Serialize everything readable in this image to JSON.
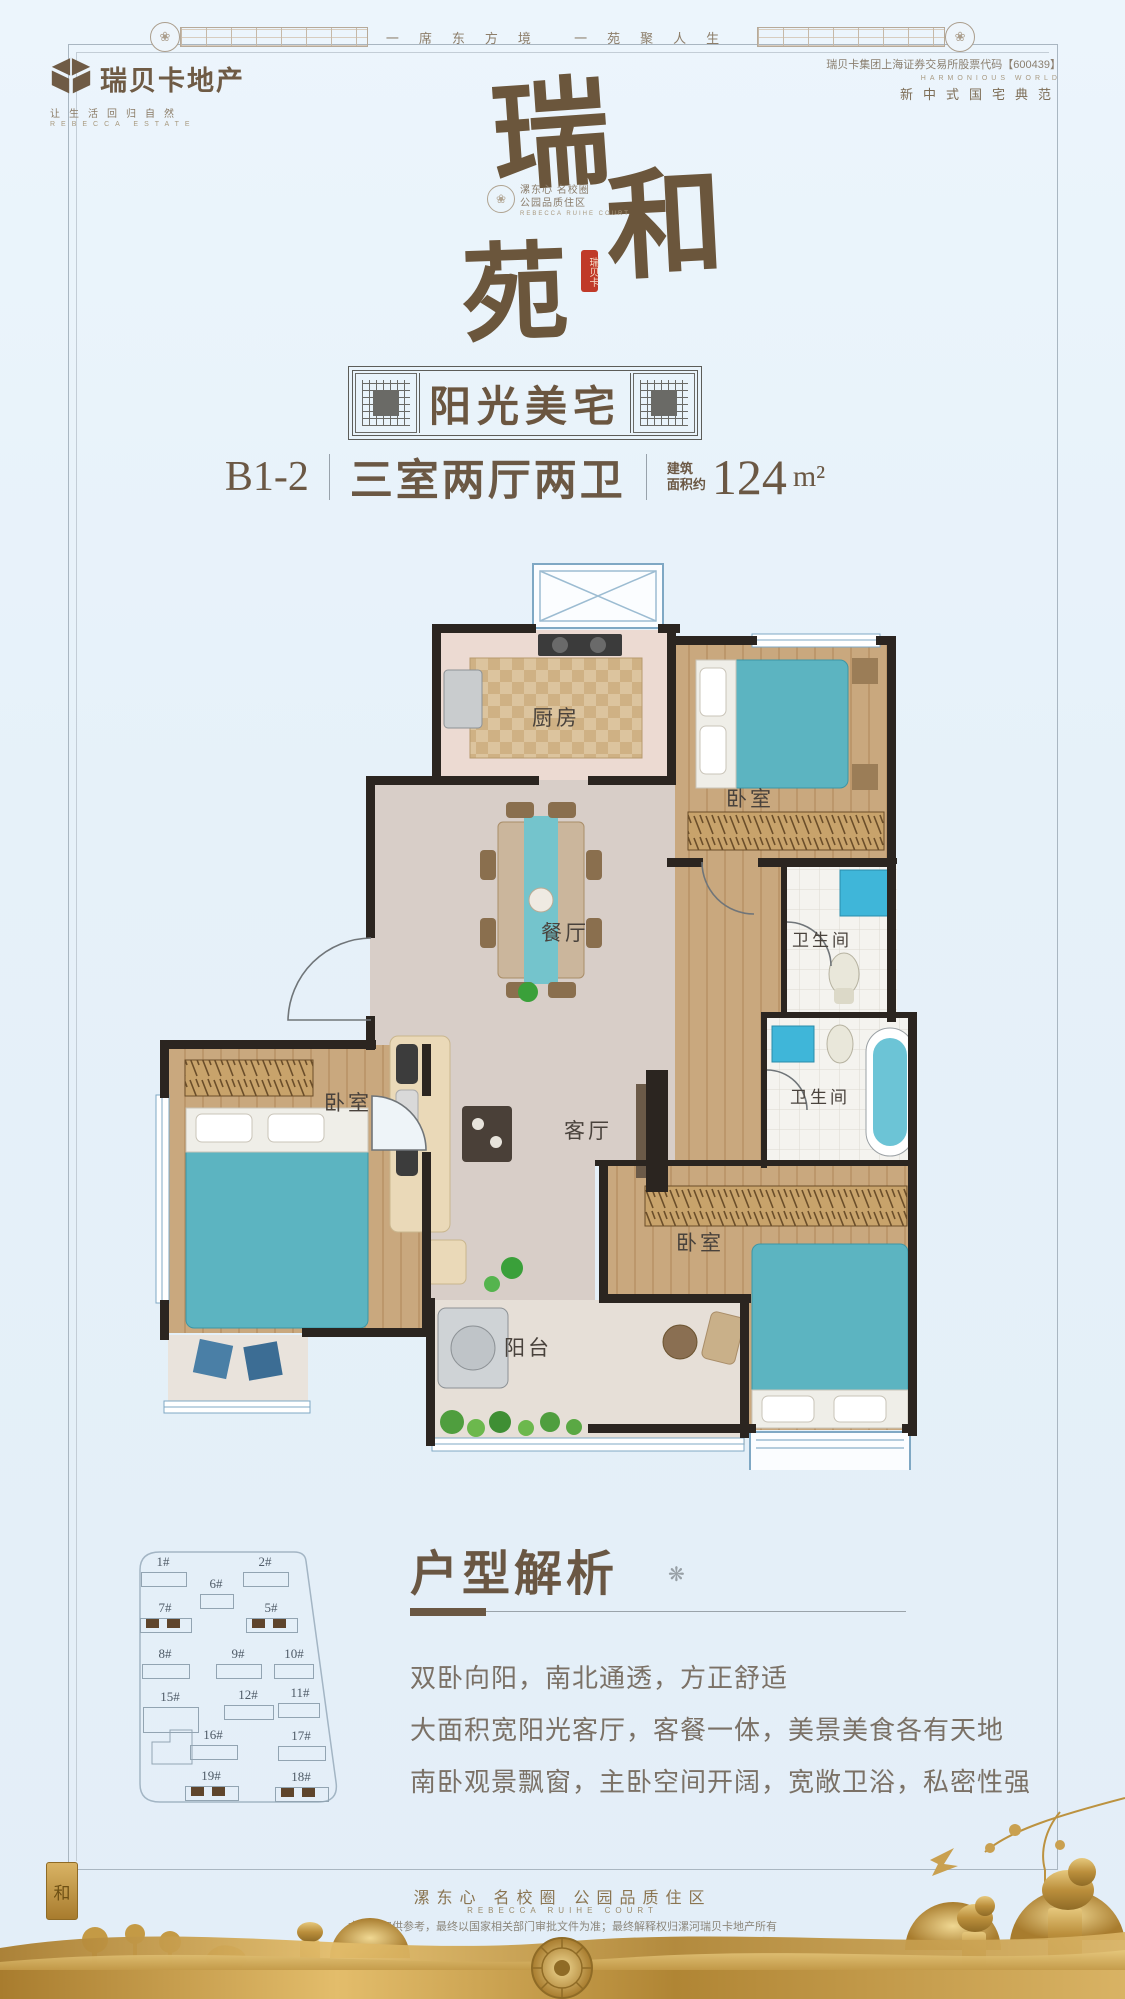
{
  "header": {
    "band_tagline": "一席东方境  一苑聚人生",
    "logo": {
      "name": "瑞贝卡地产",
      "slogan": "让生活回归自然",
      "slogan_en": "REBECCA ESTATE"
    },
    "right": {
      "stock_line": "瑞贝卡集团上海证券交易所股票代码【600439】",
      "en_line": "HARMONIOUS WORLD",
      "motto": "新中式国宅典范"
    }
  },
  "brand": {
    "char1": "瑞",
    "char2": "和",
    "char3": "苑",
    "seal": "瑞贝卡",
    "ornament_icon": "❀",
    "sub_line1": "漯东心 名校圈",
    "sub_line2": "公园品质住区",
    "sub_en": "REBECCA RUIHE COURT"
  },
  "banner": {
    "title": "阳光美宅"
  },
  "unit": {
    "code": "B1-2",
    "layout": "三室两厅两卫",
    "area_prefix_line1": "建筑",
    "area_prefix_line2": "面积约",
    "area_value": "124",
    "area_unit": "m²"
  },
  "floorplan": {
    "labels": {
      "kitchen": "厨房",
      "bedroom_north": "卧室",
      "dining": "餐厅",
      "bath_upper": "卫生间",
      "living": "客厅",
      "bath_lower": "卫生间",
      "bedroom_west": "卧室",
      "bedroom_south": "卧室",
      "balcony": "阳台"
    }
  },
  "siteplan": {
    "buildings": [
      {
        "id": "1#"
      },
      {
        "id": "2#"
      },
      {
        "id": "6#"
      },
      {
        "id": "7#"
      },
      {
        "id": "5#"
      },
      {
        "id": "8#"
      },
      {
        "id": "9#"
      },
      {
        "id": "10#"
      },
      {
        "id": "15#"
      },
      {
        "id": "12#"
      },
      {
        "id": "11#"
      },
      {
        "id": "16#"
      },
      {
        "id": "17#"
      },
      {
        "id": "19#"
      },
      {
        "id": "18#"
      }
    ],
    "highlighted": [
      "7#",
      "5#",
      "19#",
      "18#"
    ]
  },
  "analysis": {
    "title": "户型解析",
    "ornament_icon": "❋",
    "lines": [
      "双卧向阳，南北通透，方正舒适",
      "大面积宽阳光客厅，客餐一体，美景美食各有天地",
      "南卧观景飘窗，主卧空间开阔，宽敞卫浴，私密性强"
    ]
  },
  "footer": {
    "slogan": "漯东心 名校圈 公园品质住区",
    "slogan_en": "REBECCA RUIHE COURT",
    "disclaimer": "本资料仅供参考，最终以国家相关部门审批文件为准；最终解释权归漯河瑞贝卡地产所有",
    "left_emblem": "和"
  },
  "colors": {
    "background": "#e8f2fa",
    "brand_brown": "#6b563c",
    "accent_red": "#c03a28",
    "wall_black": "#2b2520",
    "wood": "#c9a87e",
    "marble": "#d8cec8",
    "teal": "#5cb4c1",
    "window_blue": "#7fa8c4",
    "gold": "#c49a45"
  }
}
